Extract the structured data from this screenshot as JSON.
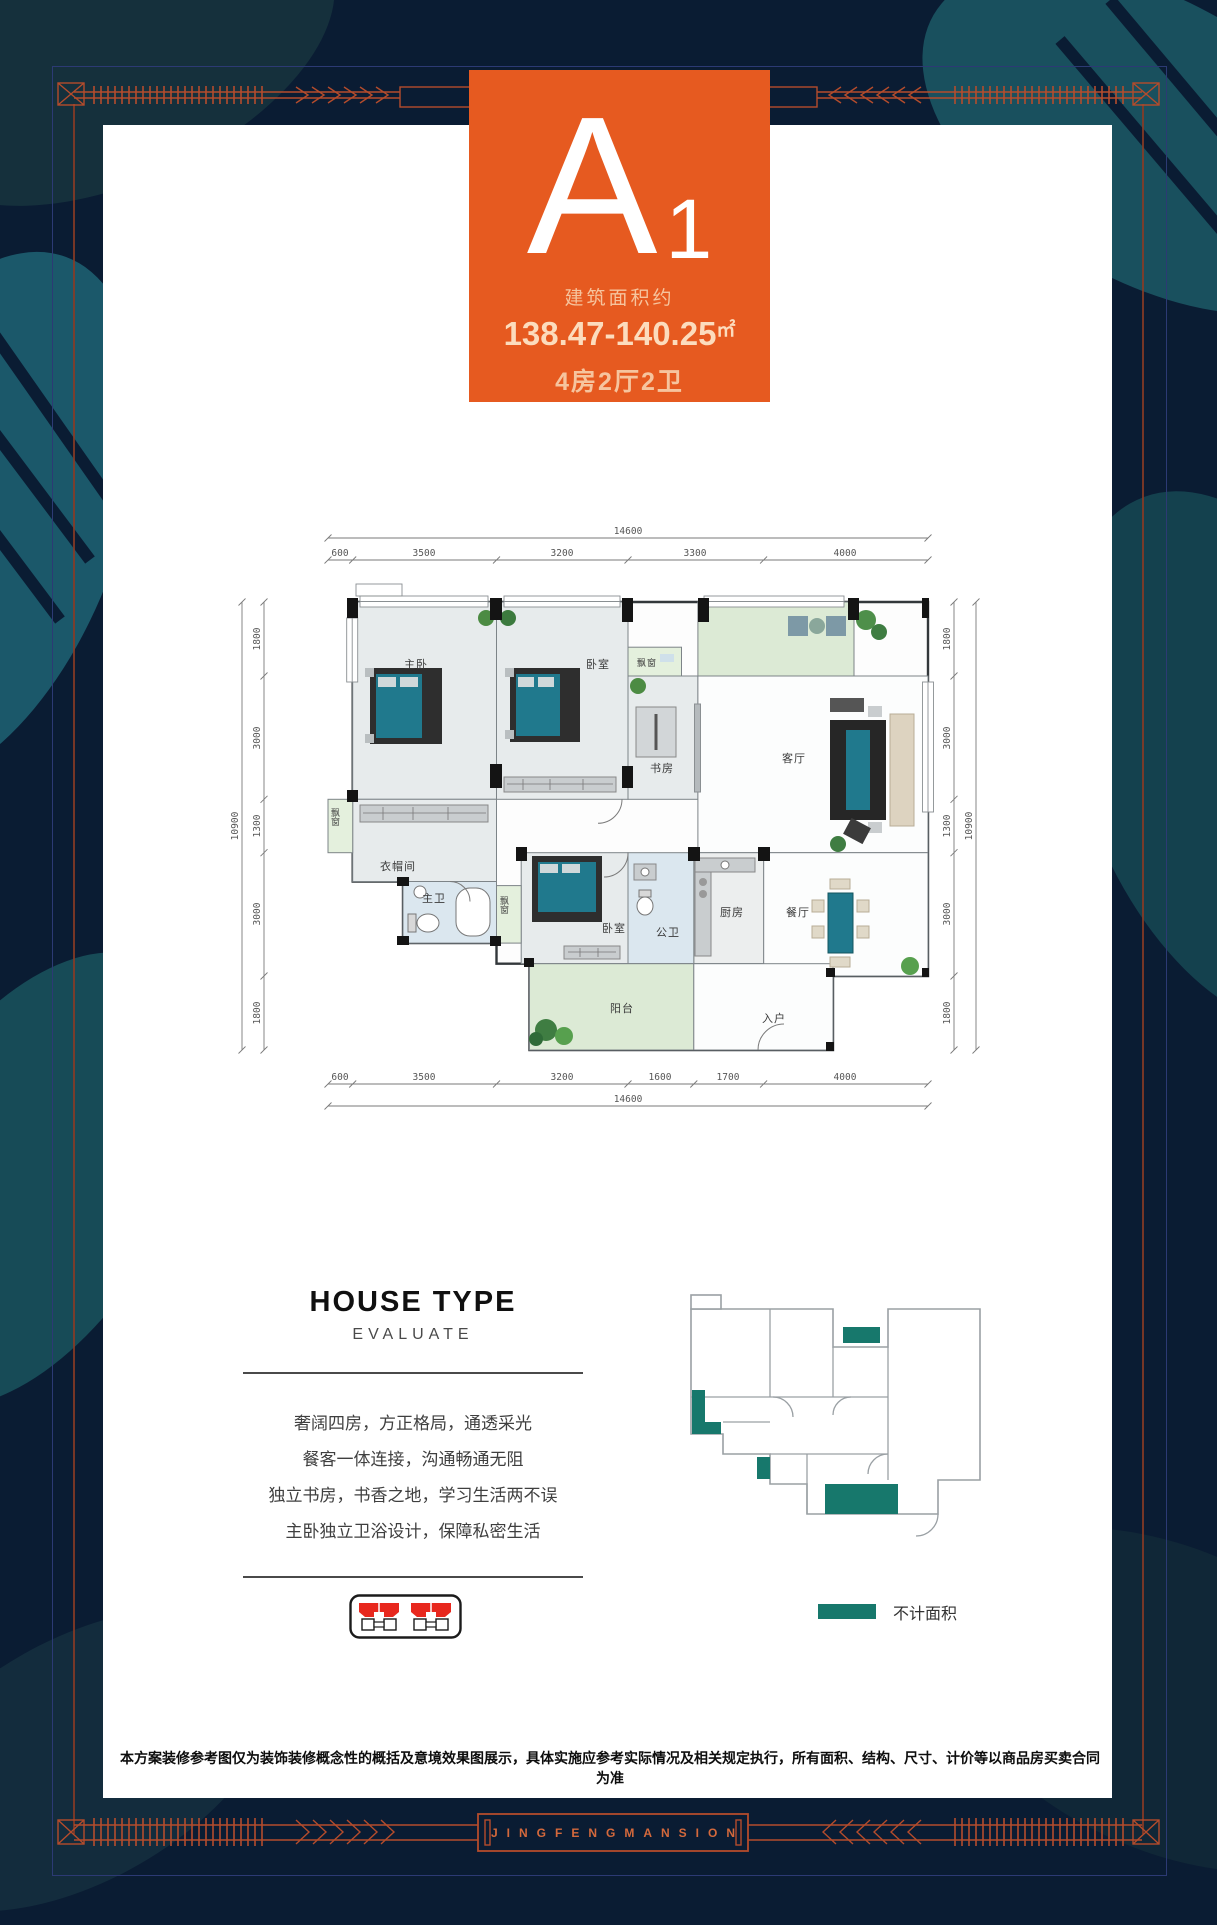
{
  "unit": {
    "letter": "A",
    "number": "1",
    "area_label": "建筑面积约",
    "area_value": "138.47-140.25",
    "area_unit": "㎡",
    "layout_value": "4房2厅2卫"
  },
  "floorplan": {
    "dim_top_total": "14600",
    "dim_top": [
      "600",
      "3500",
      "3200",
      "3300",
      "4000"
    ],
    "dim_bottom": [
      "600",
      "3500",
      "3200",
      "1600",
      "1700",
      "4000"
    ],
    "dim_bottom_total": "14600",
    "dim_left_total": "10900",
    "dim_left": [
      "1800",
      "3000",
      "1300",
      "3000",
      "1800"
    ],
    "dim_right": [
      "1800",
      "3000",
      "1300",
      "3000",
      "1800"
    ],
    "dim_right_total": "10900",
    "rooms": {
      "master": "主卧",
      "bedroom_top": "卧室",
      "study": "书房",
      "living": "客厅",
      "cloakroom": "衣帽间",
      "master_bath": "主卫",
      "bedroom_lower": "卧室",
      "public_bath": "公卫",
      "kitchen": "厨房",
      "dining": "餐厅",
      "balcony": "阳台",
      "entry": "入户",
      "bay_left": "飘窗",
      "bay_lower": "飘窗",
      "bay_study": "飘窗"
    }
  },
  "evaluate": {
    "title": "HOUSE TYPE",
    "subtitle": "EVALUATE",
    "lines": [
      "奢阔四房，方正格局，通透采光",
      "餐客一体连接，沟通畅通无阻",
      "独立书房，书香之地，学习生活两不误",
      "主卧独立卫浴设计，保障私密生活"
    ]
  },
  "legend": {
    "not_counted_label": "不计面积"
  },
  "disclaimer": "本方案装修参考图仅为装饰装修概念性的概括及意境效果图展示，具体实施应参考实际情况及相关规定执行，所有面积、结构、尺寸、计价等以商品房买卖合同为准",
  "footer": {
    "brand": "JINGFENGMANSION"
  },
  "colors": {
    "accent_orange": "#e65a20",
    "frame_orange": "#b44c2c",
    "teal_legend": "#17786c",
    "bed_teal": "#20798d",
    "background_navy": "#0a1c33"
  }
}
